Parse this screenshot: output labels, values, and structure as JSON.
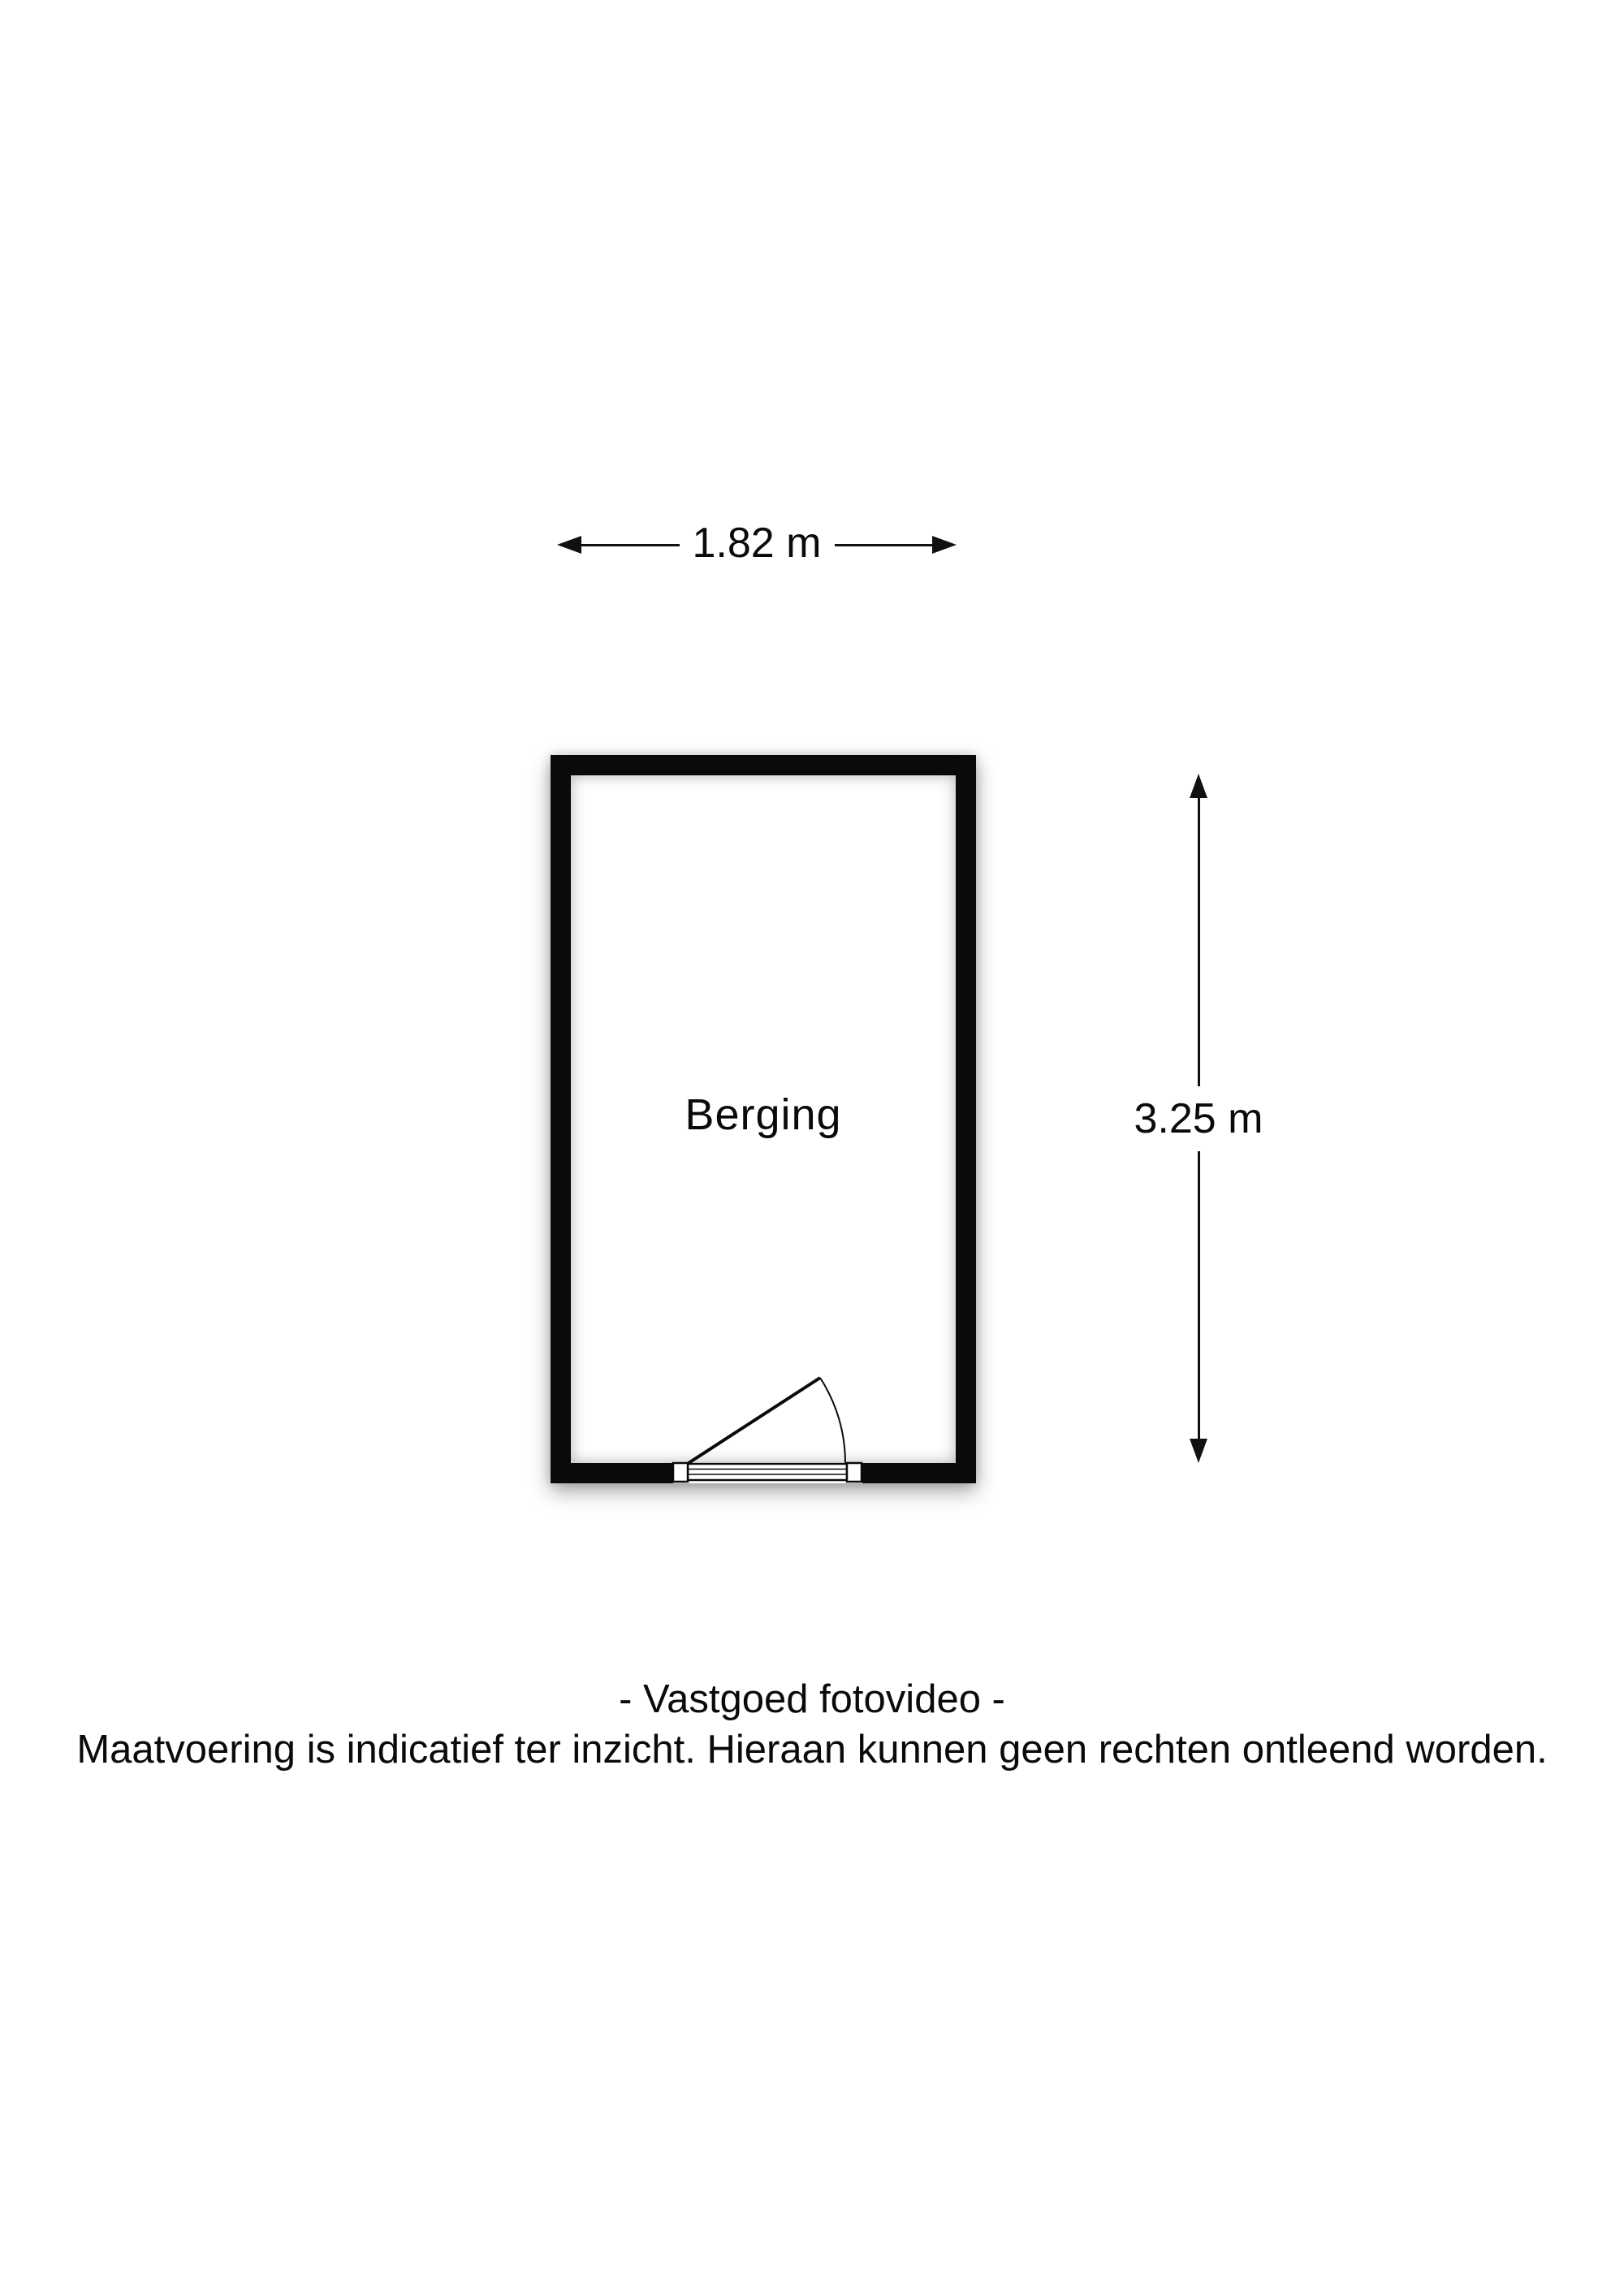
{
  "colors": {
    "background": "#ffffff",
    "ink": "#000000"
  },
  "floor_plan": {
    "room": {
      "label": "Berging"
    },
    "dimensions": {
      "width": {
        "label": "1.82 m"
      },
      "height": {
        "label": "3.25 m"
      }
    },
    "door": {
      "name": "swing-door"
    }
  },
  "footer": {
    "line1": "- Vastgoed fotovideo -",
    "line2": "Maatvoering is indicatief ter inzicht. Hieraan kunnen geen rechten ontleend worden."
  }
}
